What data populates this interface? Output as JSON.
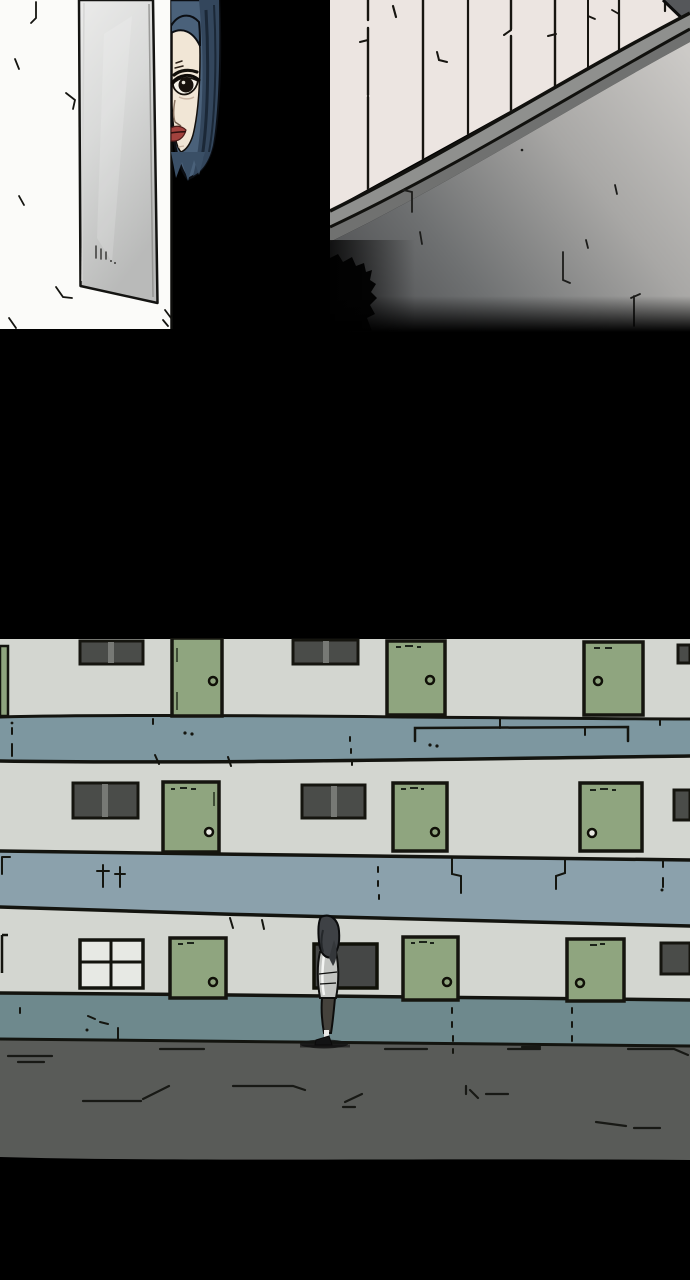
{
  "page": {
    "kind": "webtoon-comic-page",
    "width": 690,
    "height": 1280,
    "background": "#000000",
    "gutter_color": "#000000"
  },
  "palette": {
    "black_ink": "#121310",
    "left_wall_white": "#fbfbf9",
    "mirror_light": "#ebebea",
    "mirror_dark": "#b9bab9",
    "hair_blue": "#4a617a",
    "hair_blue_dark": "#33465c",
    "skin": "#f1e6d6",
    "lips_red": "#a2423e",
    "panel_wall_pink": "#ece5e1",
    "ledge_gray": "#8f908e",
    "ledge_shadow": "#707170",
    "corner_dark_gray": "#55575a",
    "lower_wall_dark": "#47484a",
    "lower_wall_light": "#cccac7",
    "apartment_wall": "#d3d6d0",
    "walkway_band_1": "#7d97a0",
    "walkway_band_2": "#8ba1ac",
    "walkway_band_3": "#6e898d",
    "door_green": "#8fa57f",
    "window_dark": "#4a4c49",
    "window_light": "#e7e9e4",
    "ground_asphalt": "#595b58",
    "figure_hood": "#3e4145",
    "figure_jacket": "#c3c5c2",
    "figure_pants": "#45423c"
  },
  "panels": [
    {
      "id": "panel-1",
      "alt": "Close panel: a blue-haired woman peeks out from behind the edge of a white wall with a tall gray mirror leaning on it; right half of panel is black",
      "elements": [
        "white-wall",
        "tall-mirror",
        "woman-half-face",
        "dark-background"
      ]
    },
    {
      "id": "panel-2",
      "alt": "Exterior panel: corner of a building seen at an angle, paneled upper wall with vertical joints, diagonal roof ledge, large concrete wall fading to dark, black shrub in lower left",
      "elements": [
        "paneled-upper-wall",
        "diagonal-ledge",
        "concrete-wall",
        "bush-silhouette"
      ]
    },
    {
      "id": "panel-3",
      "alt": "Wide panel: three-story apartment block with green doors, dark windows and teal walkway bands; a small hooded figure stands alone on the pavement in front of a dark window",
      "floors": 3,
      "green_doors_per_floor": 3,
      "windows_per_floor": 3,
      "elements": [
        "apartment-facade",
        "walkway-bands",
        "green-doors",
        "windows",
        "standing-figure",
        "asphalt-ground"
      ]
    }
  ],
  "figure": {
    "description": "small person standing in profile, dark hood, light jacket, dark trousers",
    "x": 328,
    "feet_y": 1045
  }
}
